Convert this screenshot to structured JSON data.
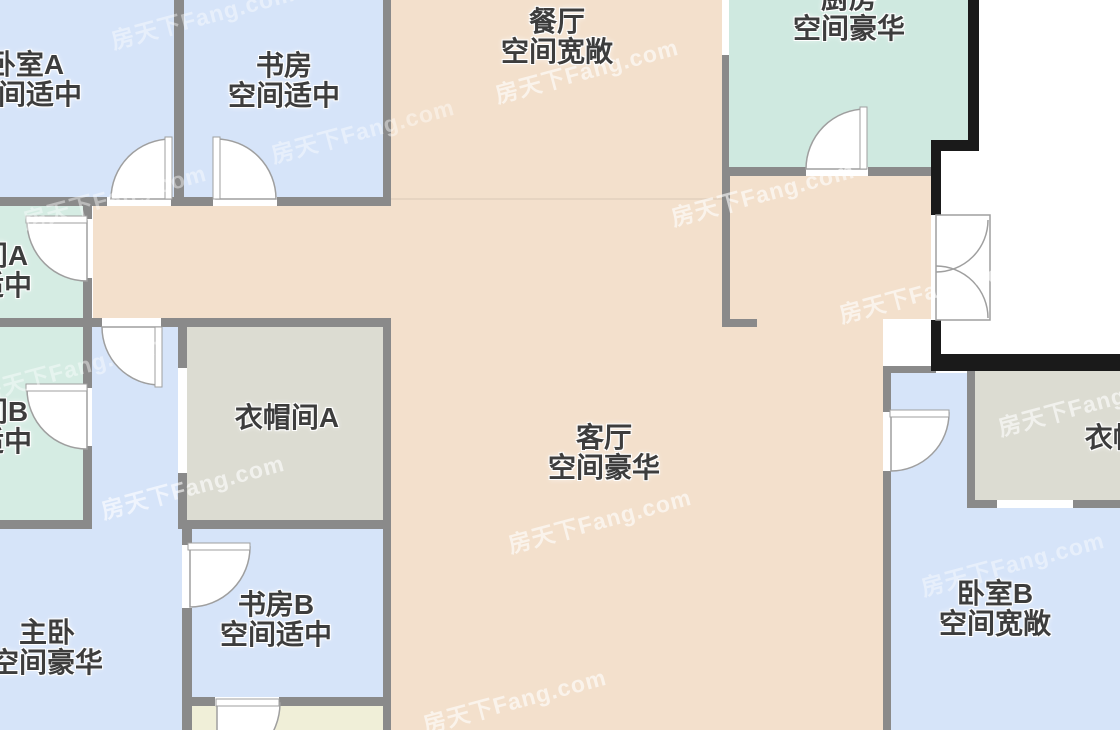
{
  "watermark": {
    "text": "房天下Fang.com"
  },
  "colors": {
    "room-blue": "#d6e4f9",
    "room-mint": "#d5ece3",
    "room-teal": "#cfe9e0",
    "room-beige": "#f3e0cc",
    "room-gray": "#dcdcd2",
    "room-cream": "#f0efd8",
    "wall-gray": "#8a8a8a",
    "wall-black": "#1a1a1a",
    "door-stroke": "#9f9f9f",
    "label-ink": "#3d3d3d",
    "watermark": "rgba(255,255,255,0.6)"
  },
  "rooms": [
    {
      "id": "bedroom-a",
      "name": "卧室A",
      "size_note": "空间适中"
    },
    {
      "id": "study",
      "name": "书房",
      "size_note": "空间适中"
    },
    {
      "id": "dining",
      "name": "餐厅",
      "size_note": "空间宽敞"
    },
    {
      "id": "kitchen",
      "name": "厨房",
      "size_note": "空间豪华"
    },
    {
      "id": "bathroom-a",
      "name": "卫生间A",
      "size_note": "空间适中"
    },
    {
      "id": "bathroom-b",
      "name": "卫生间B",
      "size_note": "空间适中"
    },
    {
      "id": "cloakroom-a",
      "name": "衣帽间A",
      "size_note": ""
    },
    {
      "id": "living-room",
      "name": "客厅",
      "size_note": "空间豪华"
    },
    {
      "id": "cloakroom-b",
      "name": "衣帽间B",
      "size_note": ""
    },
    {
      "id": "master-bedroom",
      "name": "主卧",
      "size_note": "空间豪华"
    },
    {
      "id": "study-b",
      "name": "书房B",
      "size_note": "空间适中"
    },
    {
      "id": "bedroom-b",
      "name": "卧室B",
      "size_note": "空间宽敞"
    }
  ]
}
